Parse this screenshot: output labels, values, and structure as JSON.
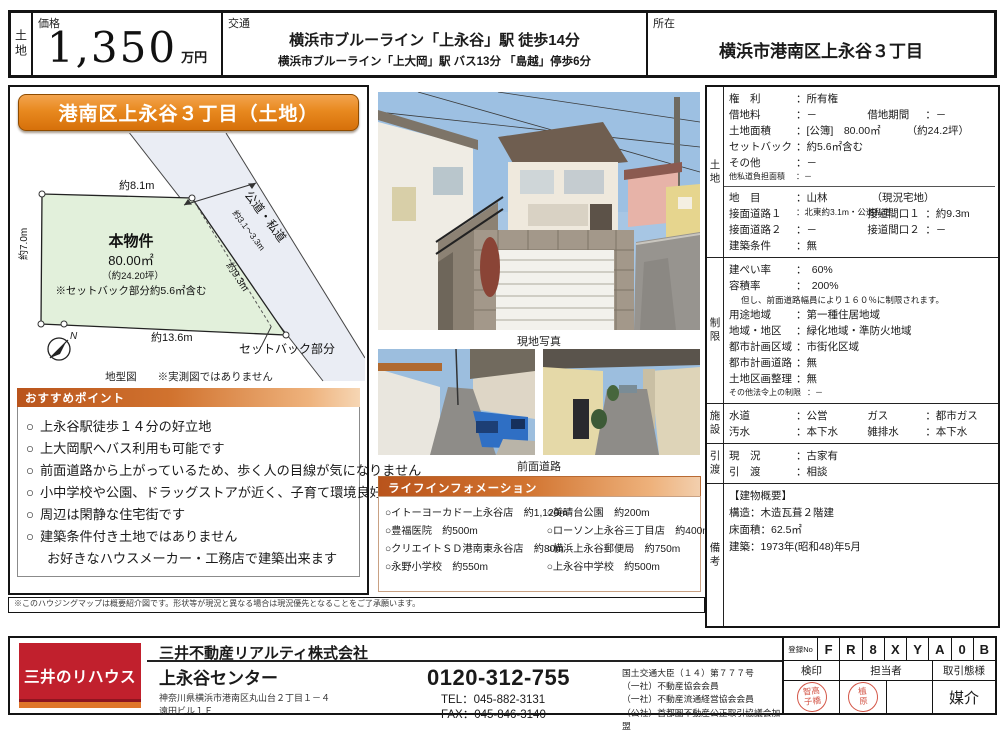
{
  "header": {
    "category": "土地",
    "price": {
      "label": "価格",
      "value": "1,350",
      "unit": "万円"
    },
    "access": {
      "label": "交通",
      "line1": "横浜市ブルーライン「上永谷」駅 徒歩14分",
      "line2": "横浜市ブルーライン「上大岡」駅 バス13分 「島越」停歩6分"
    },
    "location": {
      "label": "所在",
      "value": "横浜市港南区上永谷３丁目"
    }
  },
  "left": {
    "title": "港南区上永谷３丁目（土地）",
    "diagram": {
      "top_dim": "約8.1m",
      "left_dim": "約7.0m",
      "bottom_dim": "約13.6m",
      "diag_dim": "約9.3m",
      "road_name": "公道・私道",
      "road_width": "約3.1～3.3m",
      "parcel_title": "本物件",
      "parcel_area": "80.00㎡",
      "parcel_tsubo": "（約24.20坪）",
      "parcel_note": "※セットバック部分約5.6㎡含む",
      "setback_label": "セットバック部分",
      "compass_n": "N",
      "caption": "地型図　　※実測図ではありません"
    },
    "points": {
      "header": "おすすめポイント",
      "marker": "○",
      "items": [
        "上永谷駅徒歩１４分の好立地",
        "上大岡駅へバス利用も可能です",
        "前面道路から上がっているため、歩く人の目線が気になりません",
        "小中学校や公園、ドラッグストアが近く、子育て環境良好です",
        "周辺は閑静な住宅街です",
        "建築条件付き土地ではありません"
      ],
      "sub_item": "お好きなハウスメーカー・工務店で建築出来ます"
    },
    "disclaimer": "※このハウジングマップは概要紹介図です。形状等が現況と異なる場合は現況優先となることをご了承願います。"
  },
  "photos": {
    "main_caption": "現地写真",
    "street_caption": "前面道路"
  },
  "life": {
    "header": "ライフインフォメーション",
    "marker": "○",
    "left": [
      "イトーヨーカドー上永谷店　約1,120m",
      "豊福医院　約500m",
      "クリエイトＳＤ港南東永谷店　約80m",
      "永野小学校　約550m"
    ],
    "right": [
      "美晴台公園　約200m",
      "ローソン上永谷三丁目店　約400m",
      "横浜上永谷郵便局　約750m",
      "上永谷中学校　約500m"
    ]
  },
  "details": {
    "land": {
      "tab": "土地",
      "r1": {
        "l": "権　利",
        "v": "：所有権"
      },
      "r2": {
        "l": "借地料",
        "v": "：－",
        "l2": "借地期間",
        "v2": "：－"
      },
      "r3": {
        "l": "土地面積",
        "v": "：[公簿]　80.00㎡",
        "v2": "（約24.2坪）"
      },
      "r4": {
        "l": "セットバック",
        "v": "：約5.6㎡含む"
      },
      "r5": {
        "l": "その他",
        "v": "：－"
      },
      "r6": {
        "l": "他私道負担面積",
        "v": "：－"
      },
      "r7": {
        "l": "地　目",
        "v": "：山林",
        "v2": "（現況宅地）"
      },
      "r8": {
        "l": "接面道路１",
        "v": "：北東約3.1m・公道私道",
        "l2": "接道間口１",
        "v2": "：約9.3m"
      },
      "r9": {
        "l": "接面道路２",
        "v": "：－",
        "l2": "接道間口２",
        "v2": "：－"
      },
      "r10": {
        "l": "建築条件",
        "v": "：無"
      }
    },
    "restrict": {
      "tab": "制限",
      "r1": {
        "l": "建ぺい率",
        "v": "：　60%"
      },
      "r2": {
        "l": "容積率",
        "v": "：　200%"
      },
      "note": "但し、前面道路幅員により１６０％に制限されます。",
      "r3": {
        "l": "用途地域",
        "v": "：第一種住居地域"
      },
      "r4": {
        "l": "地域・地区",
        "v": "：緑化地域・準防火地域"
      },
      "r5": {
        "l": "都市計画区域",
        "v": "：市街化区域"
      },
      "r6": {
        "l": "都市計画道路",
        "v": "：無"
      },
      "r7": {
        "l": "土地区画整理",
        "v": "：無"
      },
      "r8": {
        "l": "その他法令上の制限",
        "v": "：－"
      }
    },
    "facility": {
      "tab": "施設",
      "r1": {
        "l": "水道",
        "v": "：公営",
        "l2": "ガス",
        "v2": "：都市ガス"
      },
      "r2": {
        "l": "汚水",
        "v": "：本下水",
        "l2": "雑排水",
        "v2": "：本下水"
      }
    },
    "handover": {
      "tab": "引渡",
      "r1": {
        "l": "現　況",
        "v": "：古家有"
      },
      "r2": {
        "l": "引　渡",
        "v": "：相談"
      }
    },
    "remarks": {
      "tab": "備考",
      "lines": [
        "【建物概要】",
        "構造：木造瓦葺２階建",
        "床面積：62.5㎡",
        "建築：1973年(昭和48)年5月"
      ]
    }
  },
  "footer": {
    "logo": "三井のリハウス",
    "company": "三井不動産リアルティ株式会社",
    "office": "上永谷センター",
    "address1": "神奈川県横浜市港南区丸山台２丁目１－４",
    "address2": "遠田ビル１Ｆ",
    "freecall": "0120-312-755",
    "tel": "TEL：045-882-3131",
    "fax": "FAX：045-846-3140",
    "license": [
      "国土交通大臣（１４）第７７７号",
      "（一社）不動産協会会員",
      "（一社）不動産流通経営協会会員",
      "（公社）首都圏不動産公正取引協議会加盟"
    ],
    "reg_label": "登録No",
    "reg_chars": [
      "F",
      "R",
      "8",
      "X",
      "Y",
      "A",
      "0",
      "B"
    ],
    "col_kenin": "検印",
    "col_tanto": "担当者",
    "col_deal": "取引態様",
    "stamp1_l1": "智高",
    "stamp1_l2": "子橋",
    "stamp2_l1": "植",
    "stamp2_l2": "原",
    "deal_type": "媒介"
  }
}
